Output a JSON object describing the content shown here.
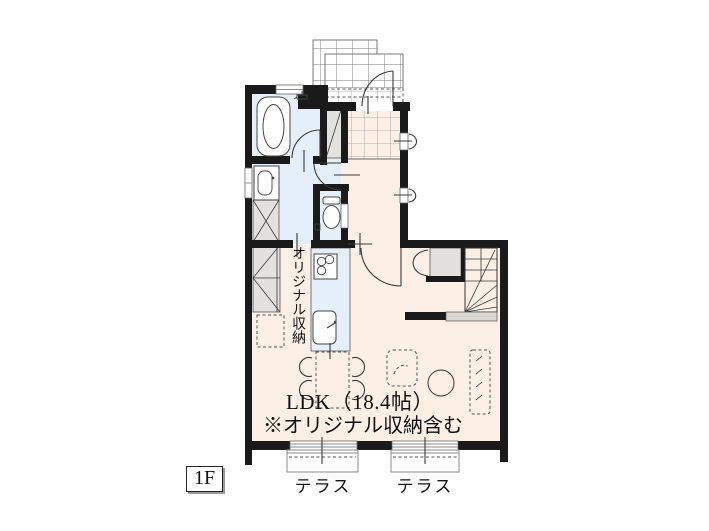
{
  "plan": {
    "floor_label": "1F",
    "ldk_label": "LDK（18.4帖）",
    "ldk_note": "※オリジナル収納含む",
    "storage_label": "オリジナル収納",
    "terraces": [
      "テラス",
      "テラス"
    ]
  },
  "colors": {
    "wall": "#1a1a1a",
    "wet_area": "#e5effa",
    "floor": "#fcefe6",
    "closet": "#e3e0dd",
    "landing": "#d9d6d2",
    "line": "#3a3a3a",
    "grid_line": "#777777",
    "tile_line": "#9a9a9a",
    "background": "#ffffff"
  }
}
